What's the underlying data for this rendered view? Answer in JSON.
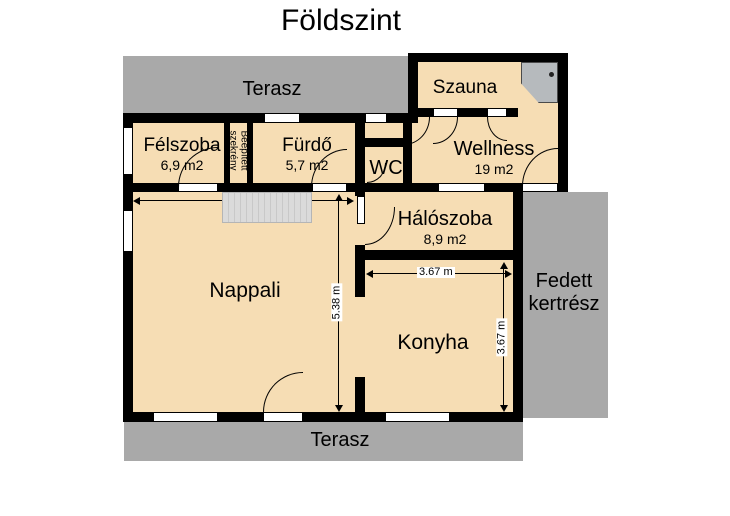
{
  "title": "Földszint",
  "rooms": {
    "terasz_top": {
      "name": "Terasz"
    },
    "terasz_bottom": {
      "name": "Terasz"
    },
    "felszoba": {
      "name": "Félszoba",
      "area": "6,9 m2"
    },
    "closet": {
      "line1": "Beépített",
      "line2": "szekrény"
    },
    "furdo": {
      "name": "Fürdő",
      "area": "5,7 m2"
    },
    "wc": {
      "name": "WC"
    },
    "szauna": {
      "name": "Szauna"
    },
    "wellness": {
      "name": "Wellness",
      "area": "19 m2"
    },
    "haloszoba": {
      "name": "Hálószoba",
      "area": "8,9 m2"
    },
    "nappali": {
      "name": "Nappali"
    },
    "konyha": {
      "name": "Konyha"
    },
    "fedett": {
      "line1": "Fedett",
      "line2": "kertrész"
    }
  },
  "dimensions": {
    "nappali_height": "5.38 m",
    "konyha_width": "3.67 m",
    "konyha_height": "3.67 m"
  },
  "colors": {
    "room_fill": "#f6ddb4",
    "terrace_gray": "#a9a9a9",
    "wall": "#000000",
    "stairs": "#d8d8d8"
  }
}
